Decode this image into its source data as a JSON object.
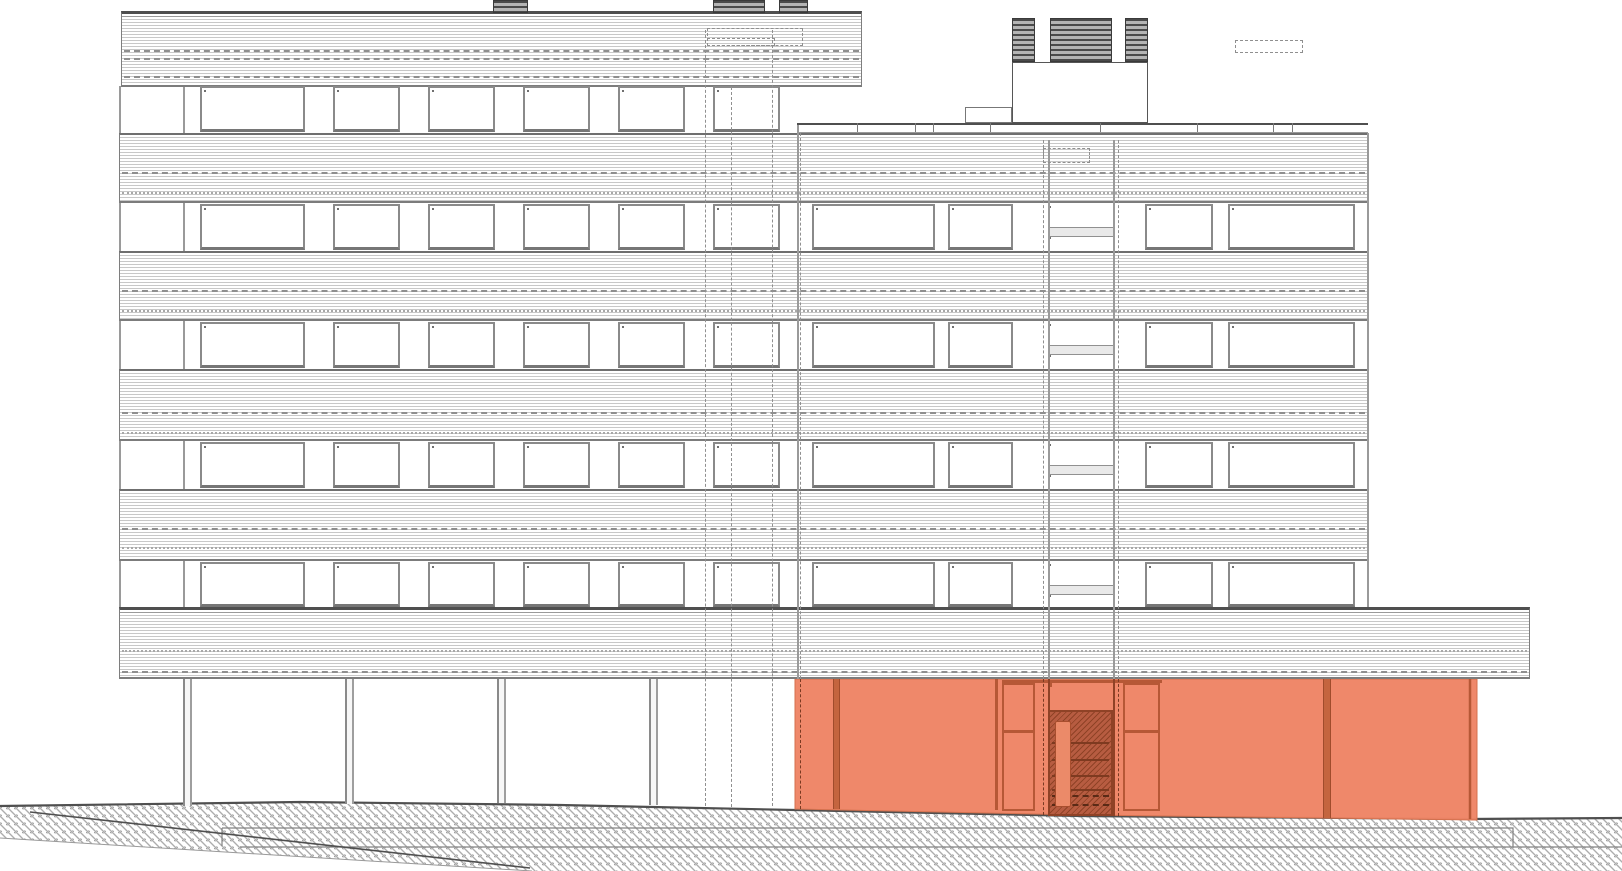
{
  "meta": {
    "title": "Building elevation drawing",
    "drawing_type": "architectural street elevation, seven-storey slab block on pilotis with ground-floor entrance zone highlighted"
  },
  "colors": {
    "paper": "#ffffff",
    "heavy_line": "#4f4f4f",
    "band_fine_line": "#c8c8c8",
    "band_edge": "#7e7e7e",
    "dash_line": "#8f8f8f",
    "dot_line": "#a8a8a8",
    "window_frame": "#8a8a8a",
    "window_inner": "#6f6f6f",
    "spandrel_fill": "#e9e9e9",
    "vent_dark": "#4a4a4a",
    "vent_light": "#b4b4b4",
    "ground_line": "#4f4f4f",
    "highlight": "#ee8465",
    "highlight_frame": "#c4653f",
    "highlight_edge": "#b65836",
    "highlight_dark": "#b75c41",
    "highlight_hatch": "#8f4226",
    "door_leaf": "#eb8a69"
  },
  "bands": [
    {
      "name": "roof-band-left",
      "x": 121,
      "y": 11,
      "w": 741,
      "h": 76,
      "heavy": true,
      "dashes": [
        {
          "t": 0.47,
          "style": "dashed"
        },
        {
          "t": 0.58,
          "style": "dashed"
        },
        {
          "t": 0.82,
          "style": "dashed"
        }
      ]
    },
    {
      "name": "spandrel-band-1",
      "x": 119,
      "y": 133,
      "w": 1249,
      "h": 70,
      "dashes": [
        {
          "t": 0.53,
          "style": "dashed"
        },
        {
          "t": 0.81,
          "style": "dotted"
        }
      ]
    },
    {
      "name": "spandrel-band-2",
      "x": 119,
      "y": 251,
      "w": 1249,
      "h": 70,
      "dashes": [
        {
          "t": 0.53,
          "style": "dashed"
        },
        {
          "t": 0.81,
          "style": "dotted"
        }
      ]
    },
    {
      "name": "spandrel-band-3",
      "x": 119,
      "y": 369,
      "w": 1249,
      "h": 72,
      "dashes": [
        {
          "t": 0.57,
          "style": "dashed"
        },
        {
          "t": 0.85,
          "style": "dotted"
        }
      ]
    },
    {
      "name": "spandrel-band-4",
      "x": 119,
      "y": 489,
      "w": 1249,
      "h": 72,
      "dashes": [
        {
          "t": 0.51,
          "style": "dashed"
        },
        {
          "t": 0.78,
          "style": "dotted"
        }
      ]
    },
    {
      "name": "ground-slab-band",
      "x": 119,
      "y": 607,
      "w": 1411,
      "h": 72,
      "heavy": true,
      "dashes": [
        {
          "t": 0.56,
          "style": "dotted"
        },
        {
          "t": 0.85,
          "style": "dashed"
        }
      ]
    }
  ],
  "window_rows": [
    {
      "y": 86,
      "h": 46,
      "windows": "left"
    },
    {
      "y": 204,
      "h": 46,
      "windows": "both"
    },
    {
      "y": 322,
      "h": 46,
      "windows": "both"
    },
    {
      "y": 442,
      "h": 46,
      "windows": "both"
    },
    {
      "y": 562,
      "h": 45,
      "windows": "both"
    }
  ],
  "windows_left": [
    [
      200,
      105
    ],
    [
      333,
      67
    ],
    [
      428,
      67
    ],
    [
      523,
      67
    ],
    [
      618,
      67
    ],
    [
      713,
      67
    ]
  ],
  "windows_right": [
    [
      812,
      123
    ],
    [
      948,
      65
    ],
    [
      1145,
      68
    ],
    [
      1228,
      127
    ]
  ],
  "stair_shaft": {
    "x": 1048,
    "w": 65,
    "top_h": 21,
    "spandrel_h": 10,
    "bottom_h": 13
  },
  "roof_left": {
    "chimneys": [
      [
        493,
        35
      ],
      [
        713,
        52
      ],
      [
        779,
        29
      ]
    ],
    "chimney_y": 0,
    "chimney_h": 13,
    "dashed_rects": [
      [
        707,
        28,
        96,
        18
      ],
      [
        707,
        38,
        68,
        8
      ]
    ]
  },
  "roof_right": {
    "parapet": {
      "x": 797,
      "y": 123,
      "x2": 1368
    },
    "ticks": [
      857,
      915,
      933,
      990,
      1100,
      1197,
      1273,
      1292
    ],
    "machine_room": {
      "x": 1012,
      "y": 62,
      "w": 136,
      "h": 61
    },
    "side_box": {
      "x": 965,
      "y": 107,
      "w": 47,
      "h": 16
    },
    "vents": [
      [
        1012,
        23
      ],
      [
        1050,
        62
      ],
      [
        1125,
        23
      ]
    ],
    "vent_y": 18,
    "vent_h": 44,
    "dashed_rects": [
      [
        1235,
        40,
        68,
        13
      ],
      [
        1043,
        148,
        47,
        15
      ]
    ]
  },
  "lines": {
    "under_solid": [
      [
        119,
        86,
        607
      ],
      [
        183,
        86,
        607
      ]
    ],
    "over_solid": [
      [
        797,
        123,
        679
      ],
      [
        1048,
        140,
        679
      ],
      [
        1113,
        140,
        679
      ],
      [
        1367,
        133,
        607
      ]
    ],
    "over_dashed": [
      [
        705,
        30,
        806
      ],
      [
        731,
        87,
        807
      ],
      [
        772,
        30,
        806
      ],
      [
        800,
        133,
        679
      ],
      [
        1043,
        140,
        679
      ],
      [
        1118,
        140,
        679
      ]
    ]
  },
  "pilotis_columns": {
    "xs": [
      [
        183,
        806
      ],
      [
        345,
        804
      ],
      [
        497,
        803
      ],
      [
        649,
        805
      ]
    ],
    "top": 679,
    "w": 9
  },
  "ground": {
    "surface": [
      [
        0,
        806
      ],
      [
        300,
        802
      ],
      [
        560,
        805
      ],
      [
        795,
        810
      ],
      [
        1080,
        816
      ],
      [
        1470,
        819
      ],
      [
        1622,
        818
      ]
    ],
    "bottom_left_cut": [
      [
        0,
        838
      ],
      [
        532,
        871
      ]
    ],
    "ramp_line": [
      [
        30,
        812
      ],
      [
        530,
        868
      ]
    ],
    "basement_path": "M222,828 H1513 V847 H1622 M240,847 H1513 M222,828 V846",
    "hatch_spacing": 8
  },
  "highlight_zone": {
    "poly": [
      [
        795,
        679
      ],
      [
        1477,
        679
      ],
      [
        1477,
        820
      ],
      [
        1080,
        815
      ],
      [
        795,
        809
      ]
    ],
    "right_edge_x": 1470,
    "dividers": [
      [
        833,
        7,
        130
      ],
      [
        1323,
        8,
        139
      ]
    ],
    "v_lines": [
      [
        995,
        131
      ]
    ],
    "head_rail": {
      "x": 1002,
      "w": 160,
      "y": 680,
      "h": 3
    },
    "panels": [
      {
        "x": 1002,
        "w": 33,
        "y": 683,
        "h": 128,
        "split": 45
      },
      {
        "x": 1123,
        "w": 37,
        "y": 683,
        "h": 128,
        "split": 45
      }
    ],
    "transom": {
      "x": 1048,
      "w": 65,
      "y": 683,
      "h": 27,
      "panes": 3
    },
    "entrance": {
      "x": 1048,
      "w": 65,
      "y": 710,
      "h": 106,
      "treads": [
        30,
        47,
        63,
        77
      ],
      "dashed_treads": [
        83,
        92
      ],
      "door": {
        "x": 5,
        "y": 9,
        "w": 16,
        "h": 86
      }
    },
    "dashed_below": [
      [
        800,
        130
      ],
      [
        1043,
        136
      ],
      [
        1118,
        137
      ]
    ],
    "solid_below": [
      [
        1048,
        137
      ],
      [
        1113,
        137
      ]
    ]
  }
}
